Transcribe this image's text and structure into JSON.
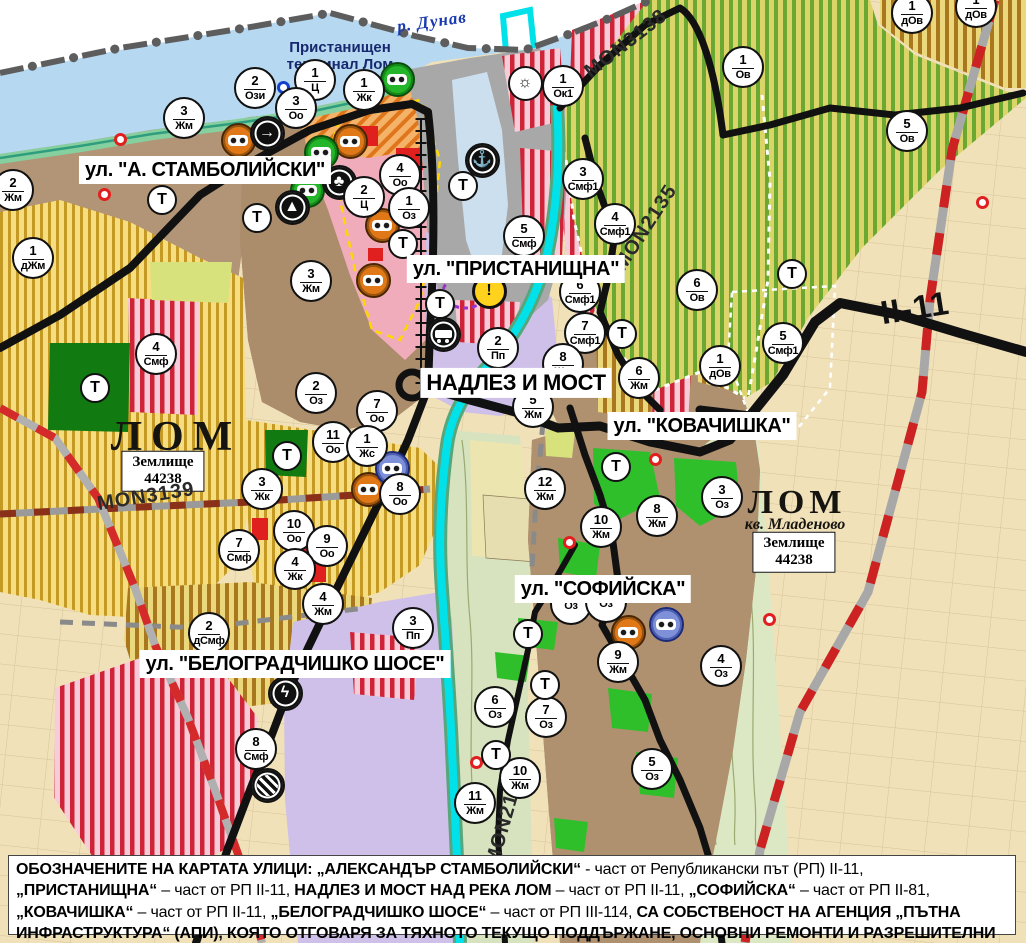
{
  "map_title": "Общ устройствен план – гр. Лом",
  "colors": {
    "water": "#b6d8f1",
    "river": "#00e1ea",
    "urban_brown": "#b09376",
    "lavender_industrial": "#cec0e8",
    "pink_central": "#f0acba",
    "green_agri_stripe": "#6aa832",
    "red_mixed_stripe": "#cf2438",
    "yellow_stripe": "#c49a25",
    "park_green": "#2fbf2a",
    "road_black": "#111111",
    "rail_red": "#cc2222",
    "note_bg": "#ffffff"
  },
  "street_labels": [
    {
      "text": "ул. \"А. СТАМБОЛИЙСКИ\"",
      "x": 205,
      "y": 170,
      "size": 20
    },
    {
      "text": "ул. \"ПРИСТАНИЩНА\"",
      "x": 516,
      "y": 269,
      "size": 20
    },
    {
      "text": "НАДЛЕЗ И МОСТ",
      "x": 516,
      "y": 383,
      "size": 22
    },
    {
      "text": "ул. \"КОВАЧИШКА\"",
      "x": 702,
      "y": 426,
      "size": 20
    },
    {
      "text": "ул. \"СОФИЙСКА\"",
      "x": 603,
      "y": 589,
      "size": 20
    },
    {
      "text": "ул. \"БЕЛОГРАДЧИШКО ШОСЕ\"",
      "x": 295,
      "y": 664,
      "size": 20
    }
  ],
  "place_labels": [
    {
      "text": "р. Дунав",
      "x": 432,
      "y": 22,
      "rot": -8,
      "cls": "water",
      "name": "river-danube-label"
    },
    {
      "text": "Пристанищен\nтерминал Лом",
      "x": 340,
      "y": 56,
      "rot": 0,
      "cls": "terminal",
      "name": "port-terminal-label"
    },
    {
      "text": "ЛОМ",
      "x": 176,
      "y": 437,
      "rot": 0,
      "cls": "city",
      "name": "city-lom-label"
    },
    {
      "text": "Землище\n44238",
      "x": 163,
      "y": 471,
      "rot": 0,
      "cls": "zem",
      "name": "land-unit-box"
    },
    {
      "text": "ЛОМ",
      "x": 797,
      "y": 503,
      "rot": 0,
      "cls": "city2",
      "name": "city-lom-label"
    },
    {
      "text": "кв. Младеново",
      "x": 795,
      "y": 525,
      "rot": 0,
      "cls": "kv",
      "name": "kvartal-mladenovo-label"
    },
    {
      "text": "Землище\n44238",
      "x": 794,
      "y": 552,
      "rot": 0,
      "cls": "zem",
      "name": "land-unit-box"
    }
  ],
  "road_labels": [
    {
      "text": "MON3139",
      "x": 146,
      "y": 497,
      "rot": -9,
      "cls": "road"
    },
    {
      "text": "MON3138",
      "x": 626,
      "y": 44,
      "rot": -38,
      "cls": "road"
    },
    {
      "text": "MON2135",
      "x": 646,
      "y": 228,
      "rot": -57,
      "cls": "road"
    },
    {
      "text": "MON2136",
      "x": 506,
      "y": 818,
      "rot": -74,
      "cls": "road"
    },
    {
      "text": "II-11",
      "x": 915,
      "y": 308,
      "rot": -9,
      "cls": "roadbig"
    }
  ],
  "markers": [
    {
      "x": 255,
      "y": 88,
      "n": "2",
      "c": "Ози"
    },
    {
      "x": 315,
      "y": 80,
      "n": "1",
      "c": "Ц"
    },
    {
      "x": 296,
      "y": 108,
      "n": "3",
      "c": "Оо"
    },
    {
      "x": 364,
      "y": 90,
      "n": "1",
      "c": "Жк"
    },
    {
      "x": 563,
      "y": 86,
      "n": "1",
      "c": "Ок1"
    },
    {
      "x": 184,
      "y": 118,
      "n": "3",
      "c": "Жм"
    },
    {
      "x": 13,
      "y": 190,
      "n": "2",
      "c": "Жм"
    },
    {
      "x": 33,
      "y": 258,
      "n": "1",
      "c": "дЖм"
    },
    {
      "x": 311,
      "y": 281,
      "n": "3",
      "c": "Жм"
    },
    {
      "x": 400,
      "y": 175,
      "n": "4",
      "c": "Оо"
    },
    {
      "x": 364,
      "y": 197,
      "n": "2",
      "c": "Ц"
    },
    {
      "x": 409,
      "y": 208,
      "n": "1",
      "c": "Оз"
    },
    {
      "x": 524,
      "y": 236,
      "n": "5",
      "c": "Смф"
    },
    {
      "x": 583,
      "y": 179,
      "n": "3",
      "c": "Смф1"
    },
    {
      "x": 615,
      "y": 224,
      "n": "4",
      "c": "Смф1"
    },
    {
      "x": 580,
      "y": 292,
      "n": "6",
      "c": "Смф1"
    },
    {
      "x": 585,
      "y": 333,
      "n": "7",
      "c": "Смф1"
    },
    {
      "x": 697,
      "y": 290,
      "n": "6",
      "c": "Ов"
    },
    {
      "x": 743,
      "y": 67,
      "n": "1",
      "c": "Ов"
    },
    {
      "x": 907,
      "y": 131,
      "n": "5",
      "c": "Ов"
    },
    {
      "x": 912,
      "y": 13,
      "n": "1",
      "c": "дОв"
    },
    {
      "x": 976,
      "y": 7,
      "n": "1",
      "c": "дОв"
    },
    {
      "x": 783,
      "y": 343,
      "n": "5",
      "c": "Смф1"
    },
    {
      "x": 720,
      "y": 366,
      "n": "1",
      "c": "дОв"
    },
    {
      "x": 639,
      "y": 378,
      "n": "6",
      "c": "Жм"
    },
    {
      "x": 563,
      "y": 364,
      "n": "8",
      "c": "Жм"
    },
    {
      "x": 533,
      "y": 407,
      "n": "5",
      "c": "Жм"
    },
    {
      "x": 545,
      "y": 489,
      "n": "12",
      "c": "Жм"
    },
    {
      "x": 601,
      "y": 527,
      "n": "10",
      "c": "Жм"
    },
    {
      "x": 657,
      "y": 516,
      "n": "8",
      "c": "Жм"
    },
    {
      "x": 722,
      "y": 497,
      "n": "3",
      "c": "Оз"
    },
    {
      "x": 316,
      "y": 393,
      "n": "2",
      "c": "Оз"
    },
    {
      "x": 377,
      "y": 411,
      "n": "7",
      "c": "Оо"
    },
    {
      "x": 333,
      "y": 442,
      "n": "11",
      "c": "Оо"
    },
    {
      "x": 367,
      "y": 446,
      "n": "1",
      "c": "Жс"
    },
    {
      "x": 262,
      "y": 489,
      "n": "3",
      "c": "Жк"
    },
    {
      "x": 400,
      "y": 494,
      "n": "8",
      "c": "Оо"
    },
    {
      "x": 294,
      "y": 531,
      "n": "10",
      "c": "Оо"
    },
    {
      "x": 327,
      "y": 546,
      "n": "9",
      "c": "Оо"
    },
    {
      "x": 295,
      "y": 569,
      "n": "4",
      "c": "Жк"
    },
    {
      "x": 239,
      "y": 550,
      "n": "7",
      "c": "Смф"
    },
    {
      "x": 156,
      "y": 354,
      "n": "4",
      "c": "Смф"
    },
    {
      "x": 209,
      "y": 633,
      "n": "2",
      "c": "дСмф"
    },
    {
      "x": 323,
      "y": 604,
      "n": "4",
      "c": "Жм"
    },
    {
      "x": 413,
      "y": 628,
      "n": "3",
      "c": "Пп"
    },
    {
      "x": 498,
      "y": 348,
      "n": "2",
      "c": "Пп"
    },
    {
      "x": 256,
      "y": 749,
      "n": "8",
      "c": "Смф"
    },
    {
      "x": 495,
      "y": 707,
      "n": "6",
      "c": "Оз"
    },
    {
      "x": 546,
      "y": 717,
      "n": "7",
      "c": "Оз"
    },
    {
      "x": 520,
      "y": 778,
      "n": "10",
      "c": "Жм"
    },
    {
      "x": 475,
      "y": 803,
      "n": "11",
      "c": "Жм"
    },
    {
      "x": 618,
      "y": 662,
      "n": "9",
      "c": "Жм"
    },
    {
      "x": 721,
      "y": 666,
      "n": "4",
      "c": "Оз"
    },
    {
      "x": 652,
      "y": 769,
      "n": "5",
      "c": "Оз"
    },
    {
      "x": 571,
      "y": 604,
      "n": "",
      "c": "Оз"
    },
    {
      "x": 606,
      "y": 602,
      "n": "",
      "c": "Оз"
    }
  ],
  "t_markers": [
    {
      "x": 162,
      "y": 200
    },
    {
      "x": 257,
      "y": 218
    },
    {
      "x": 403,
      "y": 244
    },
    {
      "x": 440,
      "y": 304
    },
    {
      "x": 463,
      "y": 186
    },
    {
      "x": 95,
      "y": 388
    },
    {
      "x": 287,
      "y": 456
    },
    {
      "x": 616,
      "y": 467
    },
    {
      "x": 622,
      "y": 334
    },
    {
      "x": 792,
      "y": 274
    },
    {
      "x": 528,
      "y": 634
    },
    {
      "x": 545,
      "y": 685
    },
    {
      "x": 496,
      "y": 755
    }
  ],
  "t_label": "Т",
  "icons": [
    {
      "t": "masks",
      "col": "orange",
      "x": 238,
      "y": 140
    },
    {
      "t": "masks",
      "col": "orange",
      "x": 350,
      "y": 141
    },
    {
      "t": "masks",
      "col": "orange",
      "x": 382,
      "y": 225
    },
    {
      "t": "masks",
      "col": "orange",
      "x": 373,
      "y": 280
    },
    {
      "t": "masks",
      "col": "orange",
      "x": 368,
      "y": 489
    },
    {
      "t": "masks",
      "col": "orange",
      "x": 628,
      "y": 632
    },
    {
      "t": "masks",
      "col": "green",
      "x": 321,
      "y": 152
    },
    {
      "t": "masks",
      "col": "green",
      "x": 307,
      "y": 190
    },
    {
      "t": "masks",
      "col": "green",
      "x": 397,
      "y": 79
    },
    {
      "t": "masks",
      "col": "blue",
      "x": 392,
      "y": 468
    },
    {
      "t": "masks",
      "col": "blue",
      "x": 666,
      "y": 624
    },
    {
      "t": "arrow",
      "x": 267,
      "y": 133
    },
    {
      "t": "trefoil",
      "x": 339,
      "y": 182
    },
    {
      "t": "monument",
      "x": 292,
      "y": 207
    },
    {
      "t": "anchor",
      "x": 482,
      "y": 160
    },
    {
      "t": "sun",
      "x": 525,
      "y": 83
    },
    {
      "t": "warning",
      "x": 489,
      "y": 291
    },
    {
      "t": "truck",
      "x": 443,
      "y": 334
    },
    {
      "t": "lightning",
      "x": 285,
      "y": 693
    },
    {
      "t": "railcross",
      "x": 267,
      "y": 785
    }
  ],
  "icon_glyphs": {
    "arrow": "→",
    "trefoil": "♣",
    "monument": "▲",
    "anchor": "⚓",
    "sun": "☼",
    "warning": "!",
    "lightning": "ϟ"
  },
  "dots": [
    {
      "c": "red",
      "x": 120,
      "y": 139
    },
    {
      "c": "red",
      "x": 104,
      "y": 194
    },
    {
      "c": "red",
      "x": 655,
      "y": 459
    },
    {
      "c": "red",
      "x": 569,
      "y": 542
    },
    {
      "c": "red",
      "x": 476,
      "y": 762
    },
    {
      "c": "red",
      "x": 769,
      "y": 619
    },
    {
      "c": "red",
      "x": 982,
      "y": 202
    },
    {
      "c": "blue",
      "x": 283,
      "y": 87
    }
  ],
  "note": {
    "segments": [
      {
        "bold": true,
        "text": "ОБОЗНАЧЕНИТЕ НА КАРТАТА УЛИЦИ: „АЛЕКСАНДЪР СТАМБОЛИЙСКИ“"
      },
      {
        "bold": false,
        "text": " - част от Републикански път (РП) II-11, "
      },
      {
        "bold": true,
        "text": "„ПРИСТАНИЩНА“"
      },
      {
        "bold": false,
        "text": " – част от РП II-11, "
      },
      {
        "bold": true,
        "text": "НАДЛЕЗ И МОСТ НАД РЕКА ЛОМ"
      },
      {
        "bold": false,
        "text": " – част от РП II-11, "
      },
      {
        "bold": true,
        "text": "„СОФИЙСКА“"
      },
      {
        "bold": false,
        "text": " – част от РП II-81, "
      },
      {
        "bold": true,
        "text": "„КОВАЧИШКА“"
      },
      {
        "bold": false,
        "text": " – част от РП II-11, "
      },
      {
        "bold": true,
        "text": "„БЕЛОГРАДЧИШКО ШОСЕ“"
      },
      {
        "bold": false,
        "text": " – част от РП III-114, "
      },
      {
        "bold": true,
        "text": "СА СОБСТВЕНОСТ НА АГЕНЦИЯ „ПЪТНА ИНФРАСТРУКТУРА“ (АПИ), КОЯТО ОТГОВАРЯ ЗА ТЯХНОТО ТЕКУЩО ПОДДЪРЖАНЕ, ОСНОВНИ РЕМОНТИ И РАЗРЕШИТЕЛНИ РЕЖИМИ."
      }
    ]
  }
}
